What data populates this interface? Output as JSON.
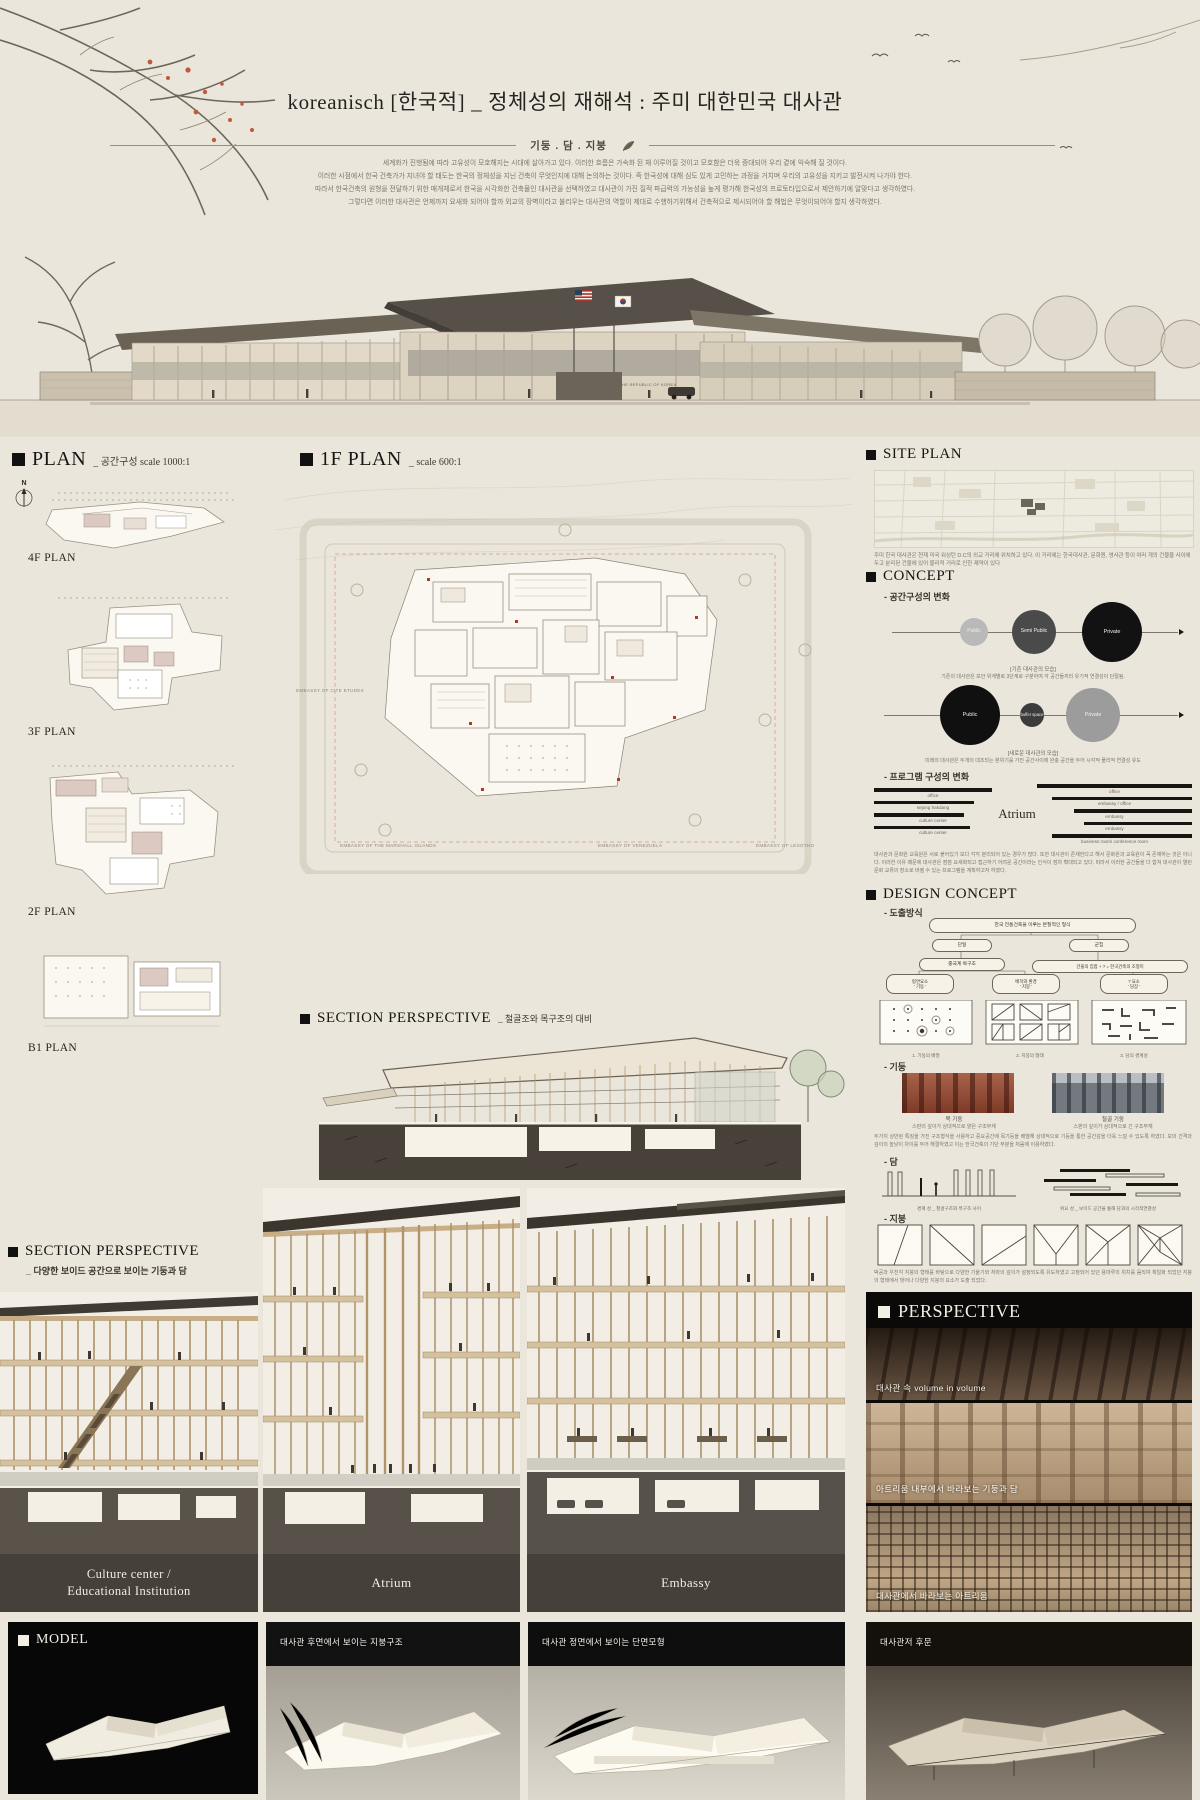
{
  "header": {
    "title": "koreanisch [한국적] _ 정체성의 재해석 :  주미 대한민국 대사관",
    "keywords": "기둥 . 담 . 지붕",
    "intro_lines": [
      "세계화가 진행됨에 따라 고유성이 모호해지는 시대에 살아가고 있다.  이러한 흐름은 가속화 된 채 이루어질 것이고 모호함은 더욱 증대되어 우리 곁에 익숙해 질 것이다.",
      "이러한 시점에서 한국 건축가가 지녀야 할 태도는  한국의 정체성을 지닌 건축이 무엇인지에 대해 논의하는 것이다.  즉 한국성에 대해 심도 있게 고민하는 과정을 거치며 우리의 고유성을 지키고 발전시켜 나가야 한다.",
      "따라서 한국건축의 원형을 전달하기 위한 매개체로서 한국을 시각화한 건축물인 대사관을 선택하였고 대사관이 가진 질적 파급력의 가능성을 높게 평가해 한국성의 프로토타입으로서 제안하기에 알맞다고 생각하였다.",
      "그렇다면 이러한 대사관은 언제까지 요새화 되어야 할까 외교의 장벽이라고 불리우는 대사관의 역할이 제대로 수행하기위해서 건축적으로 제시되어야 할 해법은 무엇이되어야 할지 생각하였다."
    ],
    "building_sign": "EMBASSY OF THE REPUBLIC OF KOREA"
  },
  "plan": {
    "title": "PLAN",
    "subtitle": "_ 공간구성  scale 1000:1",
    "north_label": "N",
    "floors": [
      "4F PLAN",
      "3F PLAN",
      "2F PLAN",
      "B1 PLAN"
    ]
  },
  "first_floor": {
    "title": "1F PLAN",
    "subtitle": "_  scale 600:1",
    "context_left": "EMBASSY OF CITE ETUDES",
    "context_bottom": [
      "EMBASSY OF THE MARSHALL ISLANDS",
      "EMBASSY OF VENEZUELA",
      "EMBASSY OF LESOTHO"
    ]
  },
  "site_plan": {
    "title": "SITE PLAN",
    "description": "주미 한국 대사관은 현재 미국 워싱턴 D.C의 외교 거리에 위치하고 있다. 이 거리에는 한국대사관, 문화원, 영사관 등이 여러 개의 건물을 사이에 두고 분리된 건물에 있어 물리적 거리로 인한 제약이 있다"
  },
  "concept": {
    "title": "CONCEPT",
    "sub1": "- 공간구성의 변화",
    "diagram_old": {
      "circles": [
        "Public",
        "Semi Public",
        "Private"
      ],
      "caption": "[기존 대사관의 모습]",
      "note": "기존의 대사관은 보안 위계별로 3단계로 구분하여 각 공간들끼리 유기적 연결성이 단절됨."
    },
    "diagram_new": {
      "circles": [
        "Public",
        "buffer space",
        "Private"
      ],
      "caption": "[새로운 대사관의 모습]",
      "note": "미래의 대사관은 두개의 대조되는 분위기를 가진 공간사이에 완충 공간을 두어 시각적 물리적 연결성 유도"
    },
    "sub2": "- 프로그램 구성의 변화",
    "program": {
      "center": "Atrium",
      "left_labels": [
        "office",
        "sejong hakdang",
        "culture center",
        "culture center"
      ],
      "right_labels": [
        "office",
        "embassy / office",
        "embassy",
        "embassy",
        "business room/ conference room"
      ],
      "note": "대사관과 문화원 교육원은 서로 붙어있기 보다 각각 분리되어 있는 경우가 많다. 또한 대사관이 존재한다고 해서 문화원과 교육원이 꼭 존재하는 것은 아니다. 이러한 이유 때문에 대사관은 점점 요새화되고 접근하기 어려운 공간이라는 인식이 점차 확대되고 있다. 따라서 이러한 공간들을 다 합쳐 대사관이 열린 문화 교류의 장소로 바뀔 수 있는 프로그램을 계획하고자 하였다."
    }
  },
  "design_concept": {
    "title": "DESIGN CONCEPT",
    "sub": "- 도출방식",
    "flow": {
      "root": "한국 전통건축을 이루는 본질적인 형식",
      "left": "단일",
      "right": "군집",
      "left_child": "중국계 목구조",
      "right_child": "건물의 집합 + ? = 한국건축의 조형미",
      "leaves": [
        "평면요소\n' 기둥 '",
        "배치와 환경\n' 지붕 '",
        "? 요소\n' 담장 '"
      ],
      "pattern_captions": [
        "1. 기둥의 배열",
        "2. 지붕의 형태",
        "3. 담의 경계성"
      ]
    },
    "pillar": {
      "sub": "- 기둥",
      "photo_captions": [
        "목 기둥",
        "철골 기둥"
      ],
      "lines": [
        "스판의 깊이가 상대적으로 얕은 구조부재",
        "스판의 깊이가 상대적으로 긴 구조부재"
      ],
      "note": "두가지 상반된 특징을 가진 구조형식을 사용하고 중요공간에 목기둥을 배열해 상대적으로 기둥을 통한 공간감을 더욱 느낄 수 있도록 하였다. 보의 간격과 깊이의 높낮이 차이를 두어 해결하였고 이는 한국건축의 기단 부분을 처음에 이용하였다."
    },
    "wall": {
      "sub": "- 담",
      "captions": [
        "경계 성 _ 철골구조와 목구조 사이",
        "위요 성 _ 보이드 공간을 통해 담과의 시각적연결성"
      ]
    },
    "roof": {
      "sub": "- 지붕",
      "note": "박공과 우진각 지붕의 형태를 바탕으로 다양한 기울기와 처마의 깊이가 설정되도록 유도하였고 고정되어 있던 용마루의 위치를 움직여 획일화 되었던 지붕의 형태에서 벗어나 다양한 지붕의 요소가 도출 되었다."
    }
  },
  "section_mid": {
    "title": "SECTION PERSPECTIVE",
    "subtitle": "_ 철골조와 목구조의 대비"
  },
  "section_bottom": {
    "title": "SECTION PERSPECTIVE",
    "subtitle": "_ 다양한 보이드 공간으로 보이는 기둥과 담",
    "panels": [
      "Culture center /\nEducational Institution",
      "Atrium",
      "Embassy"
    ]
  },
  "perspective": {
    "title": "PERSPECTIVE",
    "captions": [
      "대사관 속 volume in volume",
      "아트리움 내부에서 바라보는 기둥과 담",
      "대사관에서 바라보는 아트리움"
    ]
  },
  "model": {
    "title": "MODEL",
    "captions": [
      "대사관 후면에서 보이는 지붕구조",
      "대사관 정면에서 보이는 단면모형",
      "대사관저 후문"
    ]
  }
}
